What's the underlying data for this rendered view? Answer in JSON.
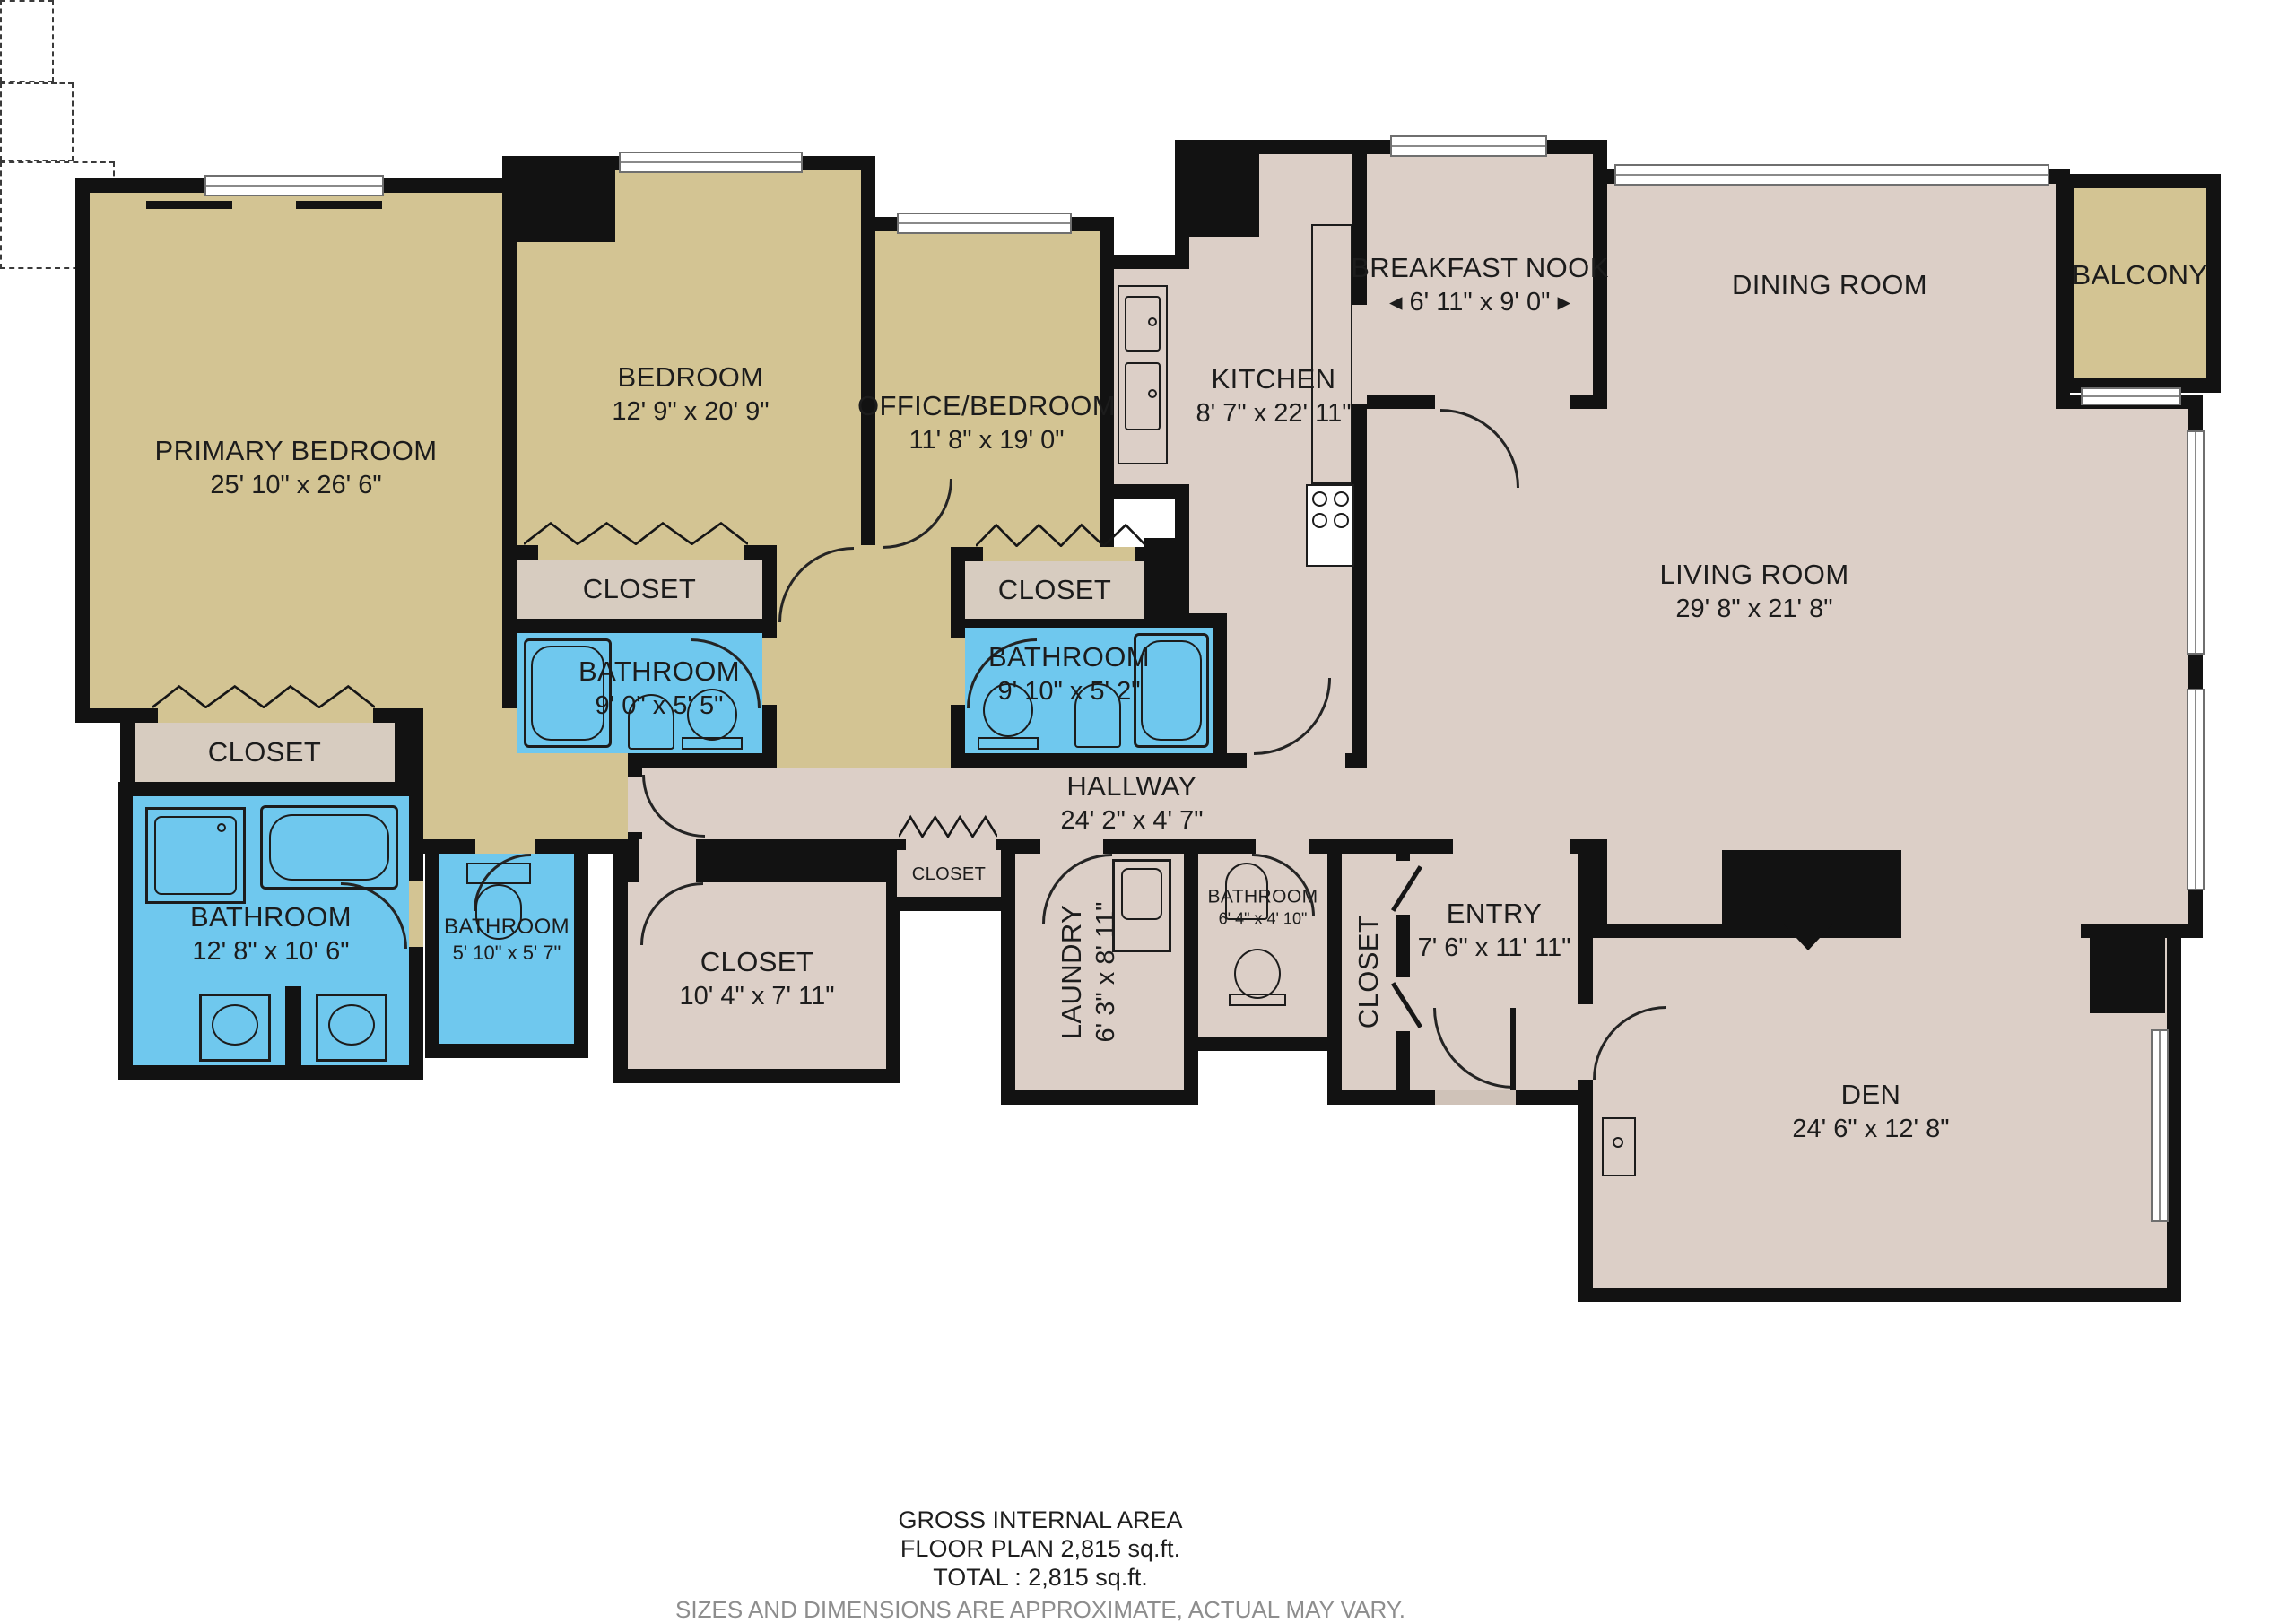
{
  "rooms": {
    "primary_bedroom": {
      "name": "PRIMARY BEDROOM",
      "dims": "25' 10\" x 26' 6\""
    },
    "bedroom": {
      "name": "BEDROOM",
      "dims": "12' 9\" x 20' 9\""
    },
    "office_bedroom": {
      "name": "OFFICE/BEDROOM",
      "dims": "11' 8\" x 19' 0\""
    },
    "breakfast_nook": {
      "name": "BREAKFAST NOOK",
      "dims": "◂ 6' 11\" x 9' 0\" ▸"
    },
    "kitchen": {
      "name": "KITCHEN",
      "dims": "8' 7\" x 22' 11\""
    },
    "dining_room": {
      "name": "DINING ROOM"
    },
    "balcony": {
      "name": "BALCONY"
    },
    "living_room": {
      "name": "LIVING ROOM",
      "dims": "29' 8\" x 21' 8\""
    },
    "primary_closet": {
      "name": "CLOSET"
    },
    "primary_bathroom": {
      "name": "BATHROOM",
      "dims": "12' 8\" x 10' 6\""
    },
    "small_bathroom": {
      "name": "BATHROOM",
      "dims": "5' 10\" x 5' 7\""
    },
    "bedroom_closet": {
      "name": "CLOSET"
    },
    "bedroom_bathroom": {
      "name": "BATHROOM",
      "dims": "9' 0\" x 5' 5\""
    },
    "office_closet": {
      "name": "CLOSET"
    },
    "office_bathroom": {
      "name": "BATHROOM",
      "dims": "9' 10\" x 5' 2\""
    },
    "hallway": {
      "name": "HALLWAY",
      "dims": "24' 2\" x 4' 7\""
    },
    "hall_closet": {
      "name": "CLOSET"
    },
    "walkin_closet": {
      "name": "CLOSET",
      "dims": "10' 4\" x 7' 11\""
    },
    "laundry": {
      "name": "LAUNDRY",
      "dims": "6' 3\" x 8' 11\""
    },
    "powder_bathroom": {
      "name": "BATHROOM",
      "dims": "6' 4\" x 4' 10\""
    },
    "entry_closet": {
      "name": "CLOSET"
    },
    "entry": {
      "name": "ENTRY",
      "dims": "7' 6\" x 11' 11\""
    },
    "den": {
      "name": "DEN",
      "dims": "24' 6\" x 12' 8\""
    }
  },
  "footer": {
    "line1": "GROSS INTERNAL AREA",
    "line2": "FLOOR PLAN 2,815 sq.ft.",
    "line3": "TOTAL :  2,815 sq.ft.",
    "disclaimer": "SIZES AND DIMENSIONS ARE APPROXIMATE, ACTUAL MAY VARY."
  },
  "colors": {
    "bedroom_floor": "#d3c493",
    "living_floor": "#dccfc7",
    "closet_floor": "#d7ccc0",
    "bathroom_floor": "#6fc8ee",
    "wall": "#121212",
    "footer_gray": "#8d8d8d"
  }
}
